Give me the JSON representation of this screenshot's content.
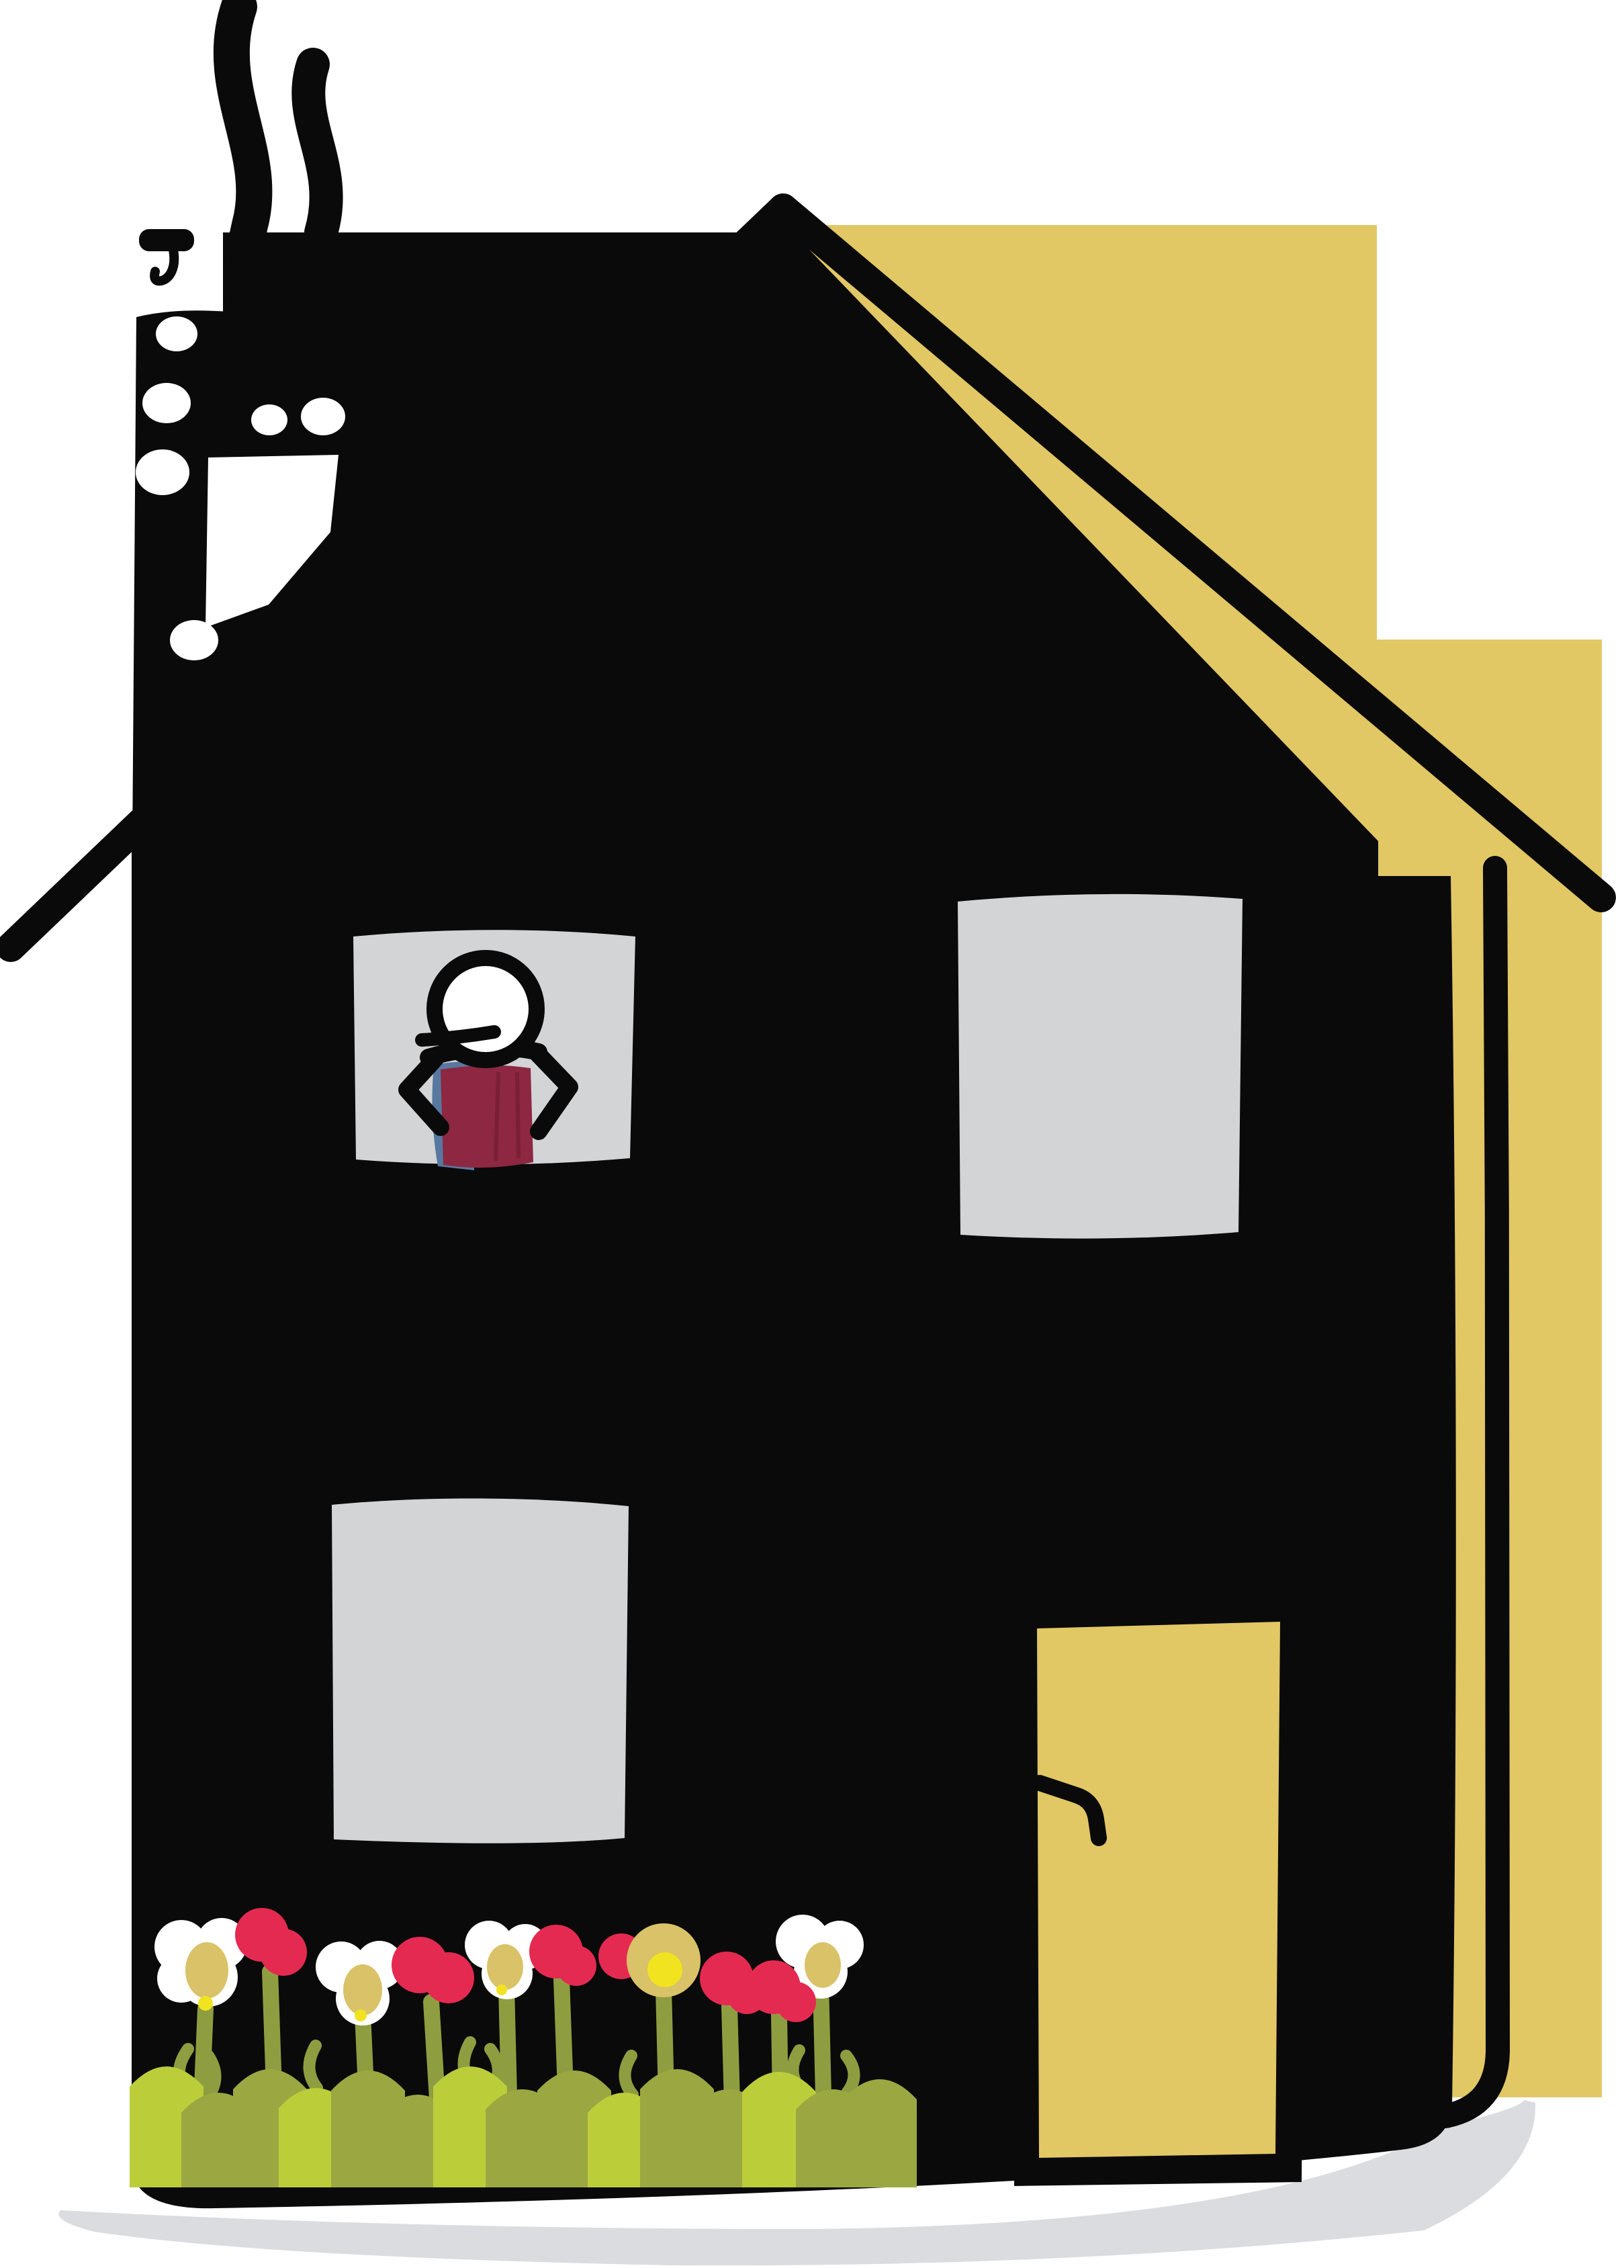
{
  "title": "Hand-drawn house illustration",
  "scene": {
    "description": "A child-like drawing of a tall black two-storey house with a smoking chimney, a pale-yellow duplicate silhouette offset behind it to the right, three light-gray windows, a stick figure with a maroon shirt standing hands-on-hips in the upper-left window, a yellow front door with a small black handle, a bed of white daisies and crimson flowers over a green hedge at the lower left, and a soft gray ground shadow underneath.",
    "objects": [
      "smoke-trails",
      "chimney",
      "black-roof",
      "yellow-offset-house",
      "upper-left-window",
      "stick-figure",
      "upper-right-window",
      "lower-left-window",
      "front-door",
      "door-handle",
      "flower-bed",
      "hedge",
      "ground-shadow"
    ]
  },
  "counts": {
    "windows": 3,
    "white_daisies": 4,
    "red_flowers": 6,
    "smoke_trails": 2,
    "chimney_holes": 6
  },
  "figure": {
    "pose": "hands on hips",
    "shirt": "maroon with blue lining"
  },
  "colors": {
    "background": "#ffffff",
    "ink": "#0a0a0a",
    "house_yellow": "#e2c765",
    "window_gray": "#d2d4d6",
    "shadow_gray": "#dadce0",
    "shirt_maroon": "#8d2742",
    "shirt_crease": "#7a1f38",
    "shirt_blue": "#5878a0",
    "flower_white": "#ffffff",
    "flower_crimson": "#e52a52",
    "flower_center_tan": "#d9c268",
    "flower_yellow": "#f1e320",
    "stem_olive": "#8f9d41",
    "hedge_olive": "#9ba841",
    "hedge_bright": "#bccd3a"
  }
}
